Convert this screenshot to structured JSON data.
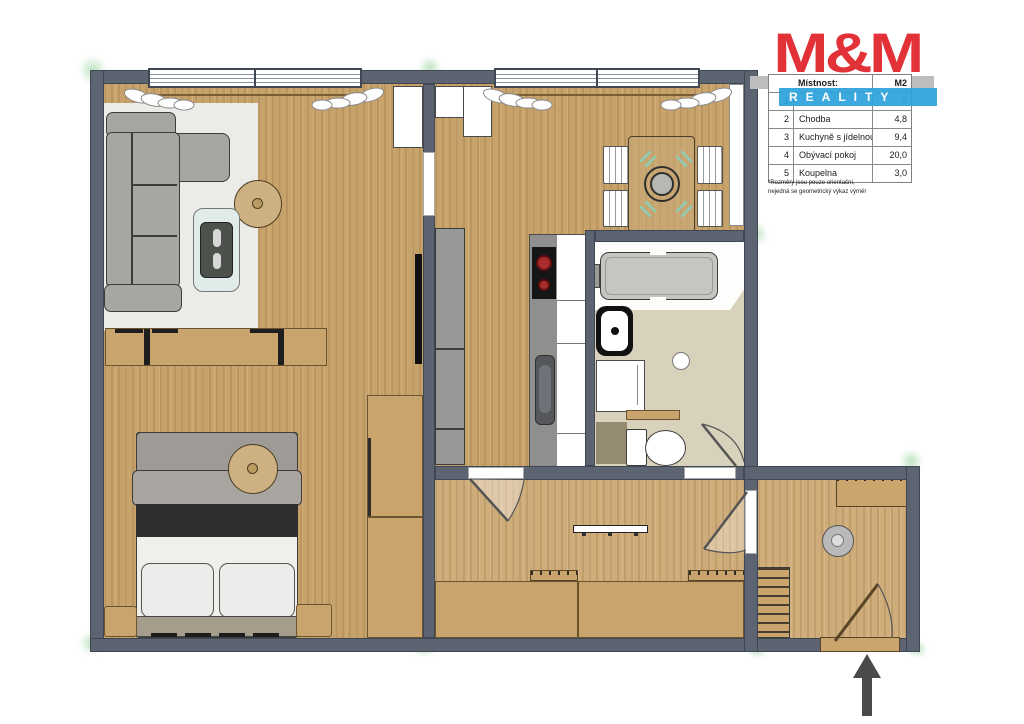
{
  "logo": {
    "title": "M&M",
    "banner": "REALITY"
  },
  "legend": {
    "header": {
      "room": "Místnost:",
      "area": "M2"
    },
    "rows": [
      {
        "num": "1",
        "name": "",
        "area": "3"
      },
      {
        "num": "2",
        "name": "Chodba",
        "area": "4,8"
      },
      {
        "num": "3",
        "name": "Kuchyně s jídelnou",
        "area": "9,4"
      },
      {
        "num": "4",
        "name": "Obývací pokoj",
        "area": "20,0"
      },
      {
        "num": "5",
        "name": "Koupelna",
        "area": "3,0"
      }
    ],
    "footnote_line1": "*Rozměry jsou pouze orientační,",
    "footnote_line2": "nejedná se geometrický výkaz výměr"
  },
  "icons": {
    "entry_arrow": "arrow-up-entrance"
  },
  "colors": {
    "wall": "#5b6470",
    "wall-border": "#3f4852",
    "wood": "#c8a26b",
    "wood-light": "#cfad7a",
    "rug": "#ebebe8",
    "bath-floor": "#d8d1bb",
    "tan": "#c9a46d",
    "tan-border": "#6b5530",
    "gray-furn": "#a7a6a3",
    "glass": "#dfecea",
    "logo-red": "#e23238",
    "logo-blue": "#2ea3dc",
    "burner-red": "#a92c2c",
    "mint": "#8fcdb4"
  }
}
